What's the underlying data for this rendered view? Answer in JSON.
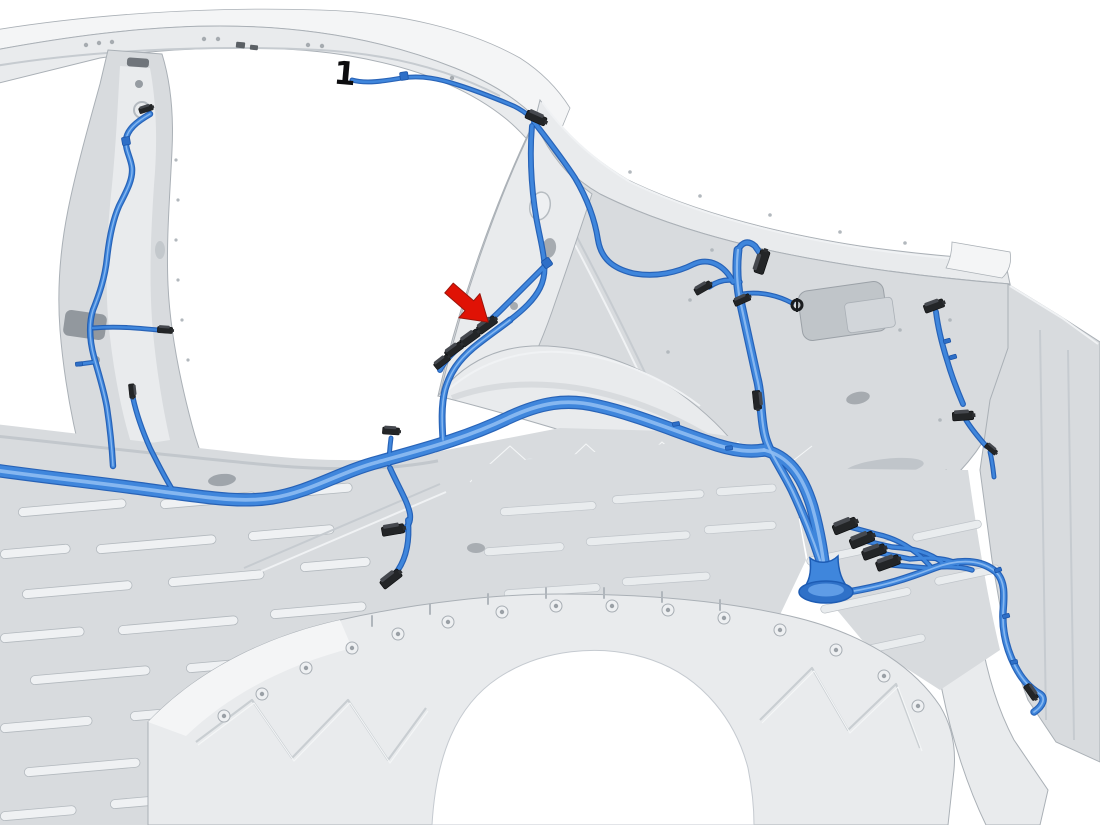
{
  "scene": {
    "background_color": "#ffffff",
    "subject": "vehicle body structure with blue wiring harness routing, rear quarter interior view"
  },
  "colors": {
    "body-base": "#d8dbde",
    "body-light": "#e9ebed",
    "body-bright": "#f4f5f6",
    "body-shadow": "#b9bec3",
    "body-deep": "#9aa0a6",
    "body-edge": "#aab0b6",
    "harness-main": "#3f86dc",
    "harness-dark": "#1d5cb4",
    "harness-light": "#8ebcf2",
    "connector-dark": "#232527",
    "connector-face": "#46494f",
    "arrow-red": "#e01205",
    "arrow-red-dark": "#9b150b",
    "callout-ink": "#0d0d0f"
  },
  "callouts": [
    {
      "id": "1",
      "label": "1"
    }
  ],
  "annotations": {
    "pointer": {
      "type": "arrow",
      "color_ref": "arrow-red",
      "points_to": "harness connector on pillar branch"
    }
  }
}
